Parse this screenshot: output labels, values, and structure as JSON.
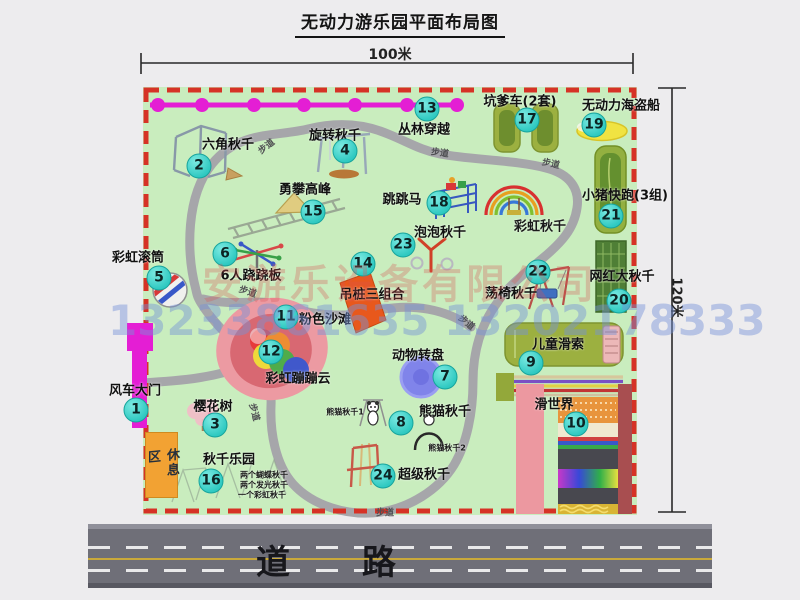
{
  "title": "无动力游乐园平面布局图",
  "dimensions": {
    "top": "100米",
    "right": "120米"
  },
  "road": {
    "label": "道 路"
  },
  "watermark": {
    "company": "安游乐设备有限公司",
    "phone": "13233861635 13202178333"
  },
  "rest_area": {
    "label": "休息区"
  },
  "colors": {
    "map_green": "#c9edbe",
    "border_red": "#d63226",
    "path_gray": "#a6a6aa",
    "badge_teal": "#2fc9c1",
    "gate_magenta": "#e41ed4",
    "road_gray": "#6f6f78"
  },
  "markers": [
    {
      "num": "1",
      "label": "风车大门",
      "cx": 136,
      "cy": 410,
      "lx": 135,
      "ly": 389
    },
    {
      "num": "2",
      "label": "六角秋千",
      "cx": 199,
      "cy": 166,
      "lx": 228,
      "ly": 143
    },
    {
      "num": "3",
      "label": "樱花树",
      "cx": 215,
      "cy": 425,
      "lx": 213,
      "ly": 405
    },
    {
      "num": "4",
      "label": "旋转秋千",
      "cx": 345,
      "cy": 151,
      "lx": 335,
      "ly": 134
    },
    {
      "num": "5",
      "label": "彩虹滚筒",
      "cx": 159,
      "cy": 278,
      "lx": 138,
      "ly": 256
    },
    {
      "num": "6",
      "label": "6人跷跷板",
      "cx": 225,
      "cy": 254,
      "lx": 251,
      "ly": 274
    },
    {
      "num": "7",
      "label": "动物转盘",
      "cx": 445,
      "cy": 377,
      "lx": 418,
      "ly": 354
    },
    {
      "num": "8",
      "label": "熊猫秋千",
      "cx": 401,
      "cy": 423,
      "lx": 445,
      "ly": 410
    },
    {
      "num": "9",
      "label": "儿童滑索",
      "cx": 531,
      "cy": 363,
      "lx": 558,
      "ly": 343
    },
    {
      "num": "10",
      "label": "滑世界",
      "cx": 576,
      "cy": 424,
      "lx": 554,
      "ly": 403
    },
    {
      "num": "11",
      "label": "粉色沙滩",
      "cx": 286,
      "cy": 317,
      "lx": 325,
      "ly": 318
    },
    {
      "num": "12",
      "label": "彩虹蹦蹦云",
      "cx": 271,
      "cy": 352,
      "lx": 298,
      "ly": 377
    },
    {
      "num": "13",
      "label": "丛林穿越",
      "cx": 427,
      "cy": 109,
      "lx": 424,
      "ly": 128
    },
    {
      "num": "14",
      "label": "吊桩三组合",
      "cx": 363,
      "cy": 264,
      "lx": 372,
      "ly": 293
    },
    {
      "num": "15",
      "label": "勇攀高峰",
      "cx": 313,
      "cy": 212,
      "lx": 305,
      "ly": 188
    },
    {
      "num": "16",
      "label": "秋千乐园",
      "cx": 211,
      "cy": 481,
      "lx": 229,
      "ly": 458
    },
    {
      "num": "17",
      "label": "坑爹车(2套)",
      "cx": 527,
      "cy": 120,
      "lx": 520,
      "ly": 100
    },
    {
      "num": "18",
      "label": "跳跳马",
      "cx": 439,
      "cy": 203,
      "lx": 402,
      "ly": 198
    },
    {
      "num": "19",
      "label": "无动力海盗船",
      "cx": 594,
      "cy": 125,
      "lx": 621,
      "ly": 104
    },
    {
      "num": "20",
      "label": "网红大秋千",
      "cx": 619,
      "cy": 301,
      "lx": 622,
      "ly": 275
    },
    {
      "num": "21",
      "label": "小猪快跑(3组)",
      "cx": 611,
      "cy": 216,
      "lx": 625,
      "ly": 194
    },
    {
      "num": "22",
      "label": "荡椅秋千",
      "cx": 538,
      "cy": 272,
      "lx": 511,
      "ly": 292
    },
    {
      "num": "23",
      "label": "泡泡秋千",
      "cx": 403,
      "cy": 245,
      "lx": 440,
      "ly": 231
    },
    {
      "num": "24",
      "label": "超级秋千",
      "cx": 383,
      "cy": 476,
      "lx": 424,
      "ly": 473
    }
  ],
  "extra_labels": [
    {
      "text": "彩虹秋千",
      "x": 540,
      "y": 225,
      "size": 13
    },
    {
      "text": "熊猫秋千1",
      "x": 345,
      "y": 412,
      "size": 8
    },
    {
      "text": "熊猫秋千2",
      "x": 447,
      "y": 448,
      "size": 8
    },
    {
      "text": "两个蝴蝶秋千",
      "x": 264,
      "y": 475,
      "size": 8
    },
    {
      "text": "两个发光秋千",
      "x": 264,
      "y": 485,
      "size": 8
    },
    {
      "text": "一个彩虹秋千",
      "x": 262,
      "y": 495,
      "size": 8
    }
  ],
  "path_labels": [
    {
      "text": "步道",
      "x": 266,
      "y": 146,
      "rot": -38
    },
    {
      "text": "步道",
      "x": 440,
      "y": 152,
      "rot": 8
    },
    {
      "text": "步道",
      "x": 551,
      "y": 163,
      "rot": 12
    },
    {
      "text": "步道",
      "x": 248,
      "y": 291,
      "rot": 18
    },
    {
      "text": "步道",
      "x": 467,
      "y": 322,
      "rot": 40
    },
    {
      "text": "步道",
      "x": 255,
      "y": 412,
      "rot": 75
    },
    {
      "text": "步道",
      "x": 385,
      "y": 512,
      "rot": 0
    }
  ]
}
